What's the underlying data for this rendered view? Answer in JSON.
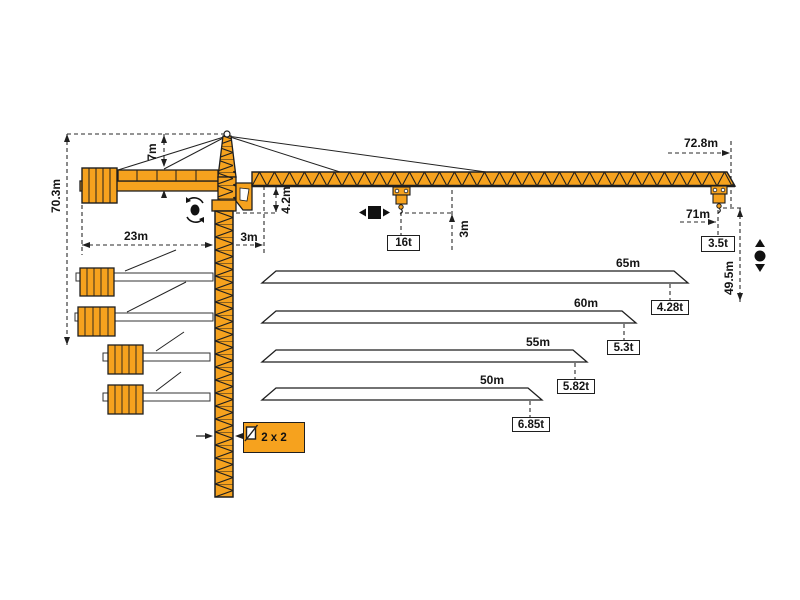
{
  "diagram_type": "tower-crane dimension and load diagram",
  "labels": {
    "total_height": "70.3m",
    "head_height": "7m",
    "counter_jib_length": "23m",
    "foot_offset": "3m",
    "jib_depth": "4.2m",
    "max_capacity": "16t",
    "hook_approach": "3m",
    "max_radius": "72.8m",
    "tip_radius": "71m",
    "tip_capacity": "3.5t",
    "lower_hook_height": "49.5m",
    "mast_section": "2 x 2"
  },
  "jib_variants": [
    {
      "length": "65m",
      "tip_load": "4.28t"
    },
    {
      "length": "60m",
      "tip_load": "5.3t"
    },
    {
      "length": "55m",
      "tip_load": "5.82t"
    },
    {
      "length": "50m",
      "tip_load": "6.85t"
    }
  ],
  "symbols": [
    "slewing-icon",
    "trolley-travel-icon",
    "hoist-icon",
    "mast-section-icon"
  ],
  "colors": {
    "crane": "#F6A21E",
    "outline": "#1f1f1f",
    "dash": "#2a2a2a"
  }
}
